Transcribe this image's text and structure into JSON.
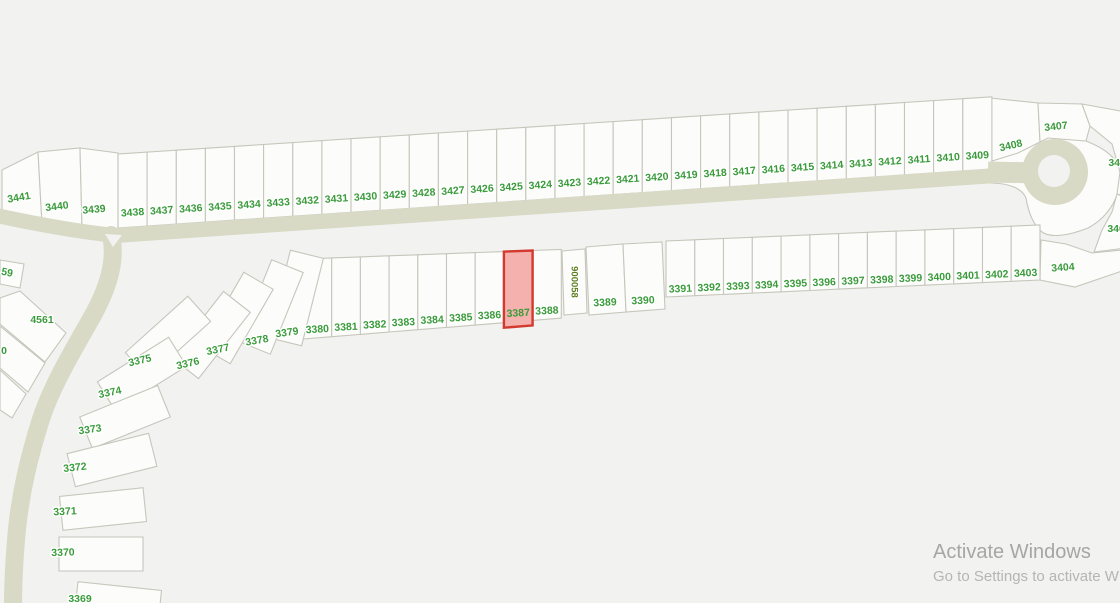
{
  "map": {
    "colors": {
      "background": "#f2f2f0",
      "lot_fill": "#fcfcfa",
      "lot_stroke": "#c6c6bc",
      "road": "#d8dac6",
      "label": "#3a9b3b",
      "label_halo": "#ffffff"
    },
    "selected_lot": {
      "id": "3387",
      "fill": "#f5b1ad",
      "stroke": "#d23a2f",
      "grow_bottom": 5
    },
    "rows": [
      {
        "lots": [
          "3438",
          "3437",
          "3436",
          "3435",
          "3434",
          "3433",
          "3432",
          "3431",
          "3430",
          "3429",
          "3428",
          "3427",
          "3426",
          "3425",
          "3424",
          "3423",
          "3422",
          "3421",
          "3420",
          "3419",
          "3418",
          "3417",
          "3416",
          "3415",
          "3414",
          "3413",
          "3412",
          "3411",
          "3410",
          "3409"
        ],
        "x0": 118,
        "dx": 29.13,
        "b0": 228,
        "bs": -0.0674,
        "t0": 154,
        "ts": -0.0655,
        "dy": -14,
        "rot": -4
      },
      {
        "lots": [
          "3380",
          "3381",
          "3382",
          "3383",
          "3384",
          "3385",
          "3386",
          "3387",
          "3388"
        ],
        "x0": 303,
        "dx": 28.7,
        "b0": 339,
        "bs": -0.081,
        "t0": 259,
        "ts": -0.037,
        "dy": -8,
        "rot": -3
      },
      {
        "lots": [
          "3391",
          "3392",
          "3393",
          "3394",
          "3395",
          "3396",
          "3397",
          "3398",
          "3399",
          "3400",
          "3401",
          "3402",
          "3403"
        ],
        "x0": 666,
        "dx": 28.77,
        "b0": 297,
        "bs": -0.0455,
        "t0": 241,
        "ts": -0.043,
        "dy": -7,
        "rot": -2.5
      }
    ],
    "special_lots": [
      {
        "id": "3441",
        "pts": [
          [
            2,
            212
          ],
          [
            42,
            224
          ],
          [
            38,
            152
          ],
          [
            2,
            170
          ]
        ],
        "lbl": [
          19,
          198
        ],
        "rot": -10
      },
      {
        "id": "3440",
        "pts": [
          [
            42,
            224
          ],
          [
            82,
            228
          ],
          [
            80,
            148
          ],
          [
            38,
            152
          ]
        ],
        "lbl": [
          57,
          207
        ],
        "rot": -7
      },
      {
        "id": "3439",
        "pts": [
          [
            82,
            228
          ],
          [
            118,
            229
          ],
          [
            118,
            153
          ],
          [
            80,
            148
          ]
        ],
        "lbl": [
          94,
          210
        ],
        "rot": -5
      },
      {
        "id": "3408",
        "pts": [
          [
            990,
            98
          ],
          [
            1038,
            103
          ],
          [
            1040,
            142
          ],
          [
            1018,
            153
          ],
          [
            992,
            161
          ]
        ],
        "lbl": [
          1011,
          146
        ],
        "rot": -13
      },
      {
        "id": "3407",
        "pts": [
          [
            1038,
            103
          ],
          [
            1082,
            104
          ],
          [
            1090,
            126
          ],
          [
            1086,
            141
          ],
          [
            1048,
            138
          ],
          [
            1040,
            142
          ]
        ],
        "lbl": [
          1056,
          127
        ],
        "rot": -6
      },
      {
        "id": "3406",
        "pts": [
          [
            1082,
            104
          ],
          [
            1126,
            112
          ],
          [
            1126,
            196
          ],
          [
            1117,
            194
          ],
          [
            1120,
            172
          ],
          [
            1112,
            144
          ],
          [
            1090,
            126
          ]
        ],
        "lbl": [
          1120,
          163
        ],
        "rot": 0
      },
      {
        "id": "3405",
        "pts": [
          [
            1117,
            194
          ],
          [
            1126,
            198
          ],
          [
            1126,
            248
          ],
          [
            1094,
            252
          ],
          [
            1102,
            230
          ],
          [
            1112,
            212
          ]
        ],
        "lbl": [
          1119,
          229
        ],
        "rot": 0
      },
      {
        "id": "3404",
        "pts": [
          [
            1040,
            280
          ],
          [
            1041,
            240
          ],
          [
            1066,
            244
          ],
          [
            1092,
            253
          ],
          [
            1122,
            250
          ],
          [
            1122,
            271
          ],
          [
            1075,
            287
          ]
        ],
        "lbl": [
          1063,
          268
        ],
        "rot": -4
      },
      {
        "id": "3389",
        "pts": [
          [
            586,
            247
          ],
          [
            623,
            244
          ],
          [
            626,
            312
          ],
          [
            589,
            315
          ]
        ],
        "lbl": [
          605,
          303
        ],
        "rot": -3
      },
      {
        "id": "3390",
        "pts": [
          [
            623,
            244
          ],
          [
            662,
            242
          ],
          [
            665,
            309
          ],
          [
            626,
            312
          ]
        ],
        "lbl": [
          643,
          301
        ],
        "rot": -3
      },
      {
        "id": "900058",
        "t": "900058",
        "pts": [
          [
            562,
            251
          ],
          [
            585,
            249
          ],
          [
            587,
            313
          ],
          [
            564,
            315
          ]
        ],
        "lbl": [
          574,
          282
        ],
        "rot": 90,
        "fs": 9.5,
        "color": "#5d7d20"
      },
      {
        "id": "4561",
        "pts": [
          [
            0,
            298
          ],
          [
            20,
            291
          ],
          [
            66,
            333
          ],
          [
            45,
            362
          ],
          [
            0,
            324
          ]
        ],
        "lbl": [
          42,
          320
        ],
        "rot": 0
      },
      {
        "id": "4559",
        "t": "59",
        "pts": [
          [
            0,
            260
          ],
          [
            24,
            264
          ],
          [
            20,
            288
          ],
          [
            0,
            284
          ]
        ],
        "lbl": [
          7,
          273
        ],
        "rot": 12
      },
      {
        "id": "4560",
        "t": "0",
        "pts": [
          [
            0,
            326
          ],
          [
            45,
            363
          ],
          [
            28,
            392
          ],
          [
            0,
            368
          ]
        ],
        "lbl": [
          4,
          351
        ],
        "rot": 0
      },
      {
        "id": "edge-lot",
        "t": "",
        "pts": [
          [
            0,
            370
          ],
          [
            26,
            394
          ],
          [
            12,
            418
          ],
          [
            0,
            410
          ]
        ]
      }
    ],
    "fan_lots": [
      {
        "id": "3379",
        "cx": 296,
        "cy": 298,
        "w": 34,
        "l": 90,
        "a": 14,
        "lbl": [
          287,
          333
        ],
        "rot": -8
      },
      {
        "id": "3378",
        "cx": 271,
        "cy": 307,
        "w": 34,
        "l": 88,
        "a": 22,
        "lbl": [
          257,
          341
        ],
        "rot": -10
      },
      {
        "id": "3377",
        "cx": 237,
        "cy": 318,
        "w": 34,
        "l": 86,
        "a": 30,
        "lbl": [
          218,
          350
        ],
        "rot": -12
      },
      {
        "id": "3376",
        "cx": 211,
        "cy": 335,
        "w": 34,
        "l": 84,
        "a": 38,
        "lbl": [
          188,
          364
        ],
        "rot": -13
      },
      {
        "id": "3375",
        "cx": 168,
        "cy": 337,
        "w": 34,
        "l": 84,
        "a": 48,
        "lbl": [
          140,
          361
        ],
        "rot": -13
      },
      {
        "id": "3374",
        "cx": 142,
        "cy": 374,
        "w": 34,
        "l": 84,
        "a": 58,
        "lbl": [
          110,
          393
        ],
        "rot": -12
      },
      {
        "id": "3373",
        "cx": 125,
        "cy": 417,
        "w": 34,
        "l": 84,
        "a": 68,
        "lbl": [
          90,
          430
        ],
        "rot": -8
      },
      {
        "id": "3372",
        "cx": 112,
        "cy": 460,
        "w": 34,
        "l": 84,
        "a": 76,
        "lbl": [
          75,
          468
        ],
        "rot": -6
      },
      {
        "id": "3371",
        "cx": 103,
        "cy": 509,
        "w": 34,
        "l": 84,
        "a": 84,
        "lbl": [
          65,
          512
        ],
        "rot": -3
      },
      {
        "id": "3370",
        "cx": 101,
        "cy": 554,
        "w": 34,
        "l": 84,
        "a": 90,
        "lbl": [
          63,
          553
        ],
        "rot": -2
      },
      {
        "id": "3369",
        "cx": 118,
        "cy": 603,
        "w": 34,
        "l": 84,
        "a": 96,
        "lbl": [
          80,
          599
        ],
        "rot": 0
      }
    ],
    "roads": {
      "main": "M -15 213 C 35 224 80 232 116 235.5 L 992 175.8",
      "main_w": 15,
      "branch": "M 111 235 C 117 262 107 290 92 317 C 74 349 53 383 41 419 C 29 457 21 491 17 529 C 14 561 13 582 13 606",
      "branch_w": 18,
      "neck": "M 988 172 L 1038 173",
      "neck_w": 21,
      "island": [
        [
          105,
          234
        ],
        [
          122,
          235
        ],
        [
          113,
          247
        ]
      ]
    },
    "culdesac": {
      "cx": 1055,
      "cy": 172,
      "r": 33,
      "hole_r": 16,
      "blob": "M 990 160 C 1016 152 1034 144 1048 138 C 1060 135 1074 136 1086 141 C 1104 148 1118 158 1120 172 C 1122 194 1110 216 1088 228 C 1068 236 1050 238 1042 232 C 1032 224 1028 210 1026 198 C 1022 188 1008 183 990 183 Z"
    },
    "label_font_size": 10.5
  },
  "watermark": {
    "title": "Activate Windows",
    "subtitle": "Go to Settings to activate W",
    "title_color": "#a6a6a6",
    "subtitle_color": "#b5b5b5"
  }
}
